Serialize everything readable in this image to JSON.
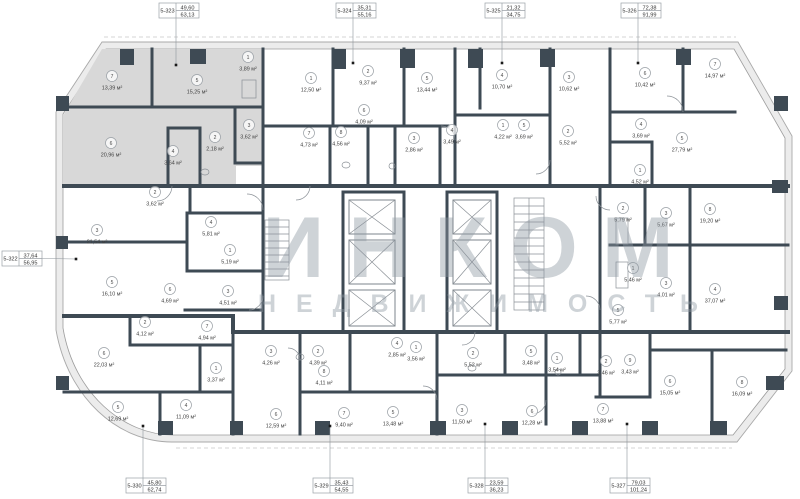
{
  "watermark": {
    "line1": "ИНКОМ",
    "line2": "НЕДВИЖИМОСТЬ"
  },
  "area_unit": "м²",
  "colors": {
    "wall": "#3e4a54",
    "highlighted_unit": "#d8d8d8",
    "outer_band": "#ececec",
    "watermark": "#8d97a1",
    "label_border": "#9aa0a6"
  },
  "callouts": [
    {
      "unit": "5-323",
      "value_top": "49,60",
      "value_bottom": "63,13",
      "side": "top",
      "box_x": 159,
      "box_y": 3,
      "dot_x": 176,
      "dot_y": 65
    },
    {
      "unit": "5-324",
      "value_top": "35,31",
      "value_bottom": "55,16",
      "side": "top",
      "box_x": 336,
      "box_y": 3,
      "dot_x": 353,
      "dot_y": 63
    },
    {
      "unit": "5-325",
      "value_top": "21,32",
      "value_bottom": "34,75",
      "side": "top",
      "box_x": 485,
      "box_y": 3,
      "dot_x": 502,
      "dot_y": 63
    },
    {
      "unit": "5-326",
      "value_top": "72,38",
      "value_bottom": "91,99",
      "side": "top",
      "box_x": 621,
      "box_y": 3,
      "dot_x": 638,
      "dot_y": 63
    },
    {
      "unit": "5-322",
      "value_top": "37,64",
      "value_bottom": "56,95",
      "side": "left",
      "box_x": 2,
      "box_y": 251,
      "dot_x": 76,
      "dot_y": 259
    },
    {
      "unit": "5-330",
      "value_top": "45,80",
      "value_bottom": "62,74",
      "side": "bottom",
      "box_x": 126,
      "box_y": 478,
      "dot_x": 143,
      "dot_y": 426
    },
    {
      "unit": "5-329",
      "value_top": "35,43",
      "value_bottom": "54,55",
      "side": "bottom",
      "box_x": 313,
      "box_y": 478,
      "dot_x": 330,
      "dot_y": 426
    },
    {
      "unit": "5-328",
      "value_top": "23,59",
      "value_bottom": "36,23",
      "side": "bottom",
      "box_x": 468,
      "box_y": 478,
      "dot_x": 485,
      "dot_y": 424
    },
    {
      "unit": "5-327",
      "value_top": "79,03",
      "value_bottom": "101,24",
      "side": "bottom",
      "box_x": 610,
      "box_y": 478,
      "dot_x": 627,
      "dot_y": 424
    }
  ],
  "rooms": [
    {
      "n": "7",
      "area": "13,39 м²",
      "x": 112,
      "y": 76
    },
    {
      "n": "5",
      "area": "15,25 м²",
      "x": 197,
      "y": 80
    },
    {
      "n": "1",
      "area": "3,89 м²",
      "x": 248,
      "y": 57
    },
    {
      "n": "6",
      "area": "20,96 м²",
      "x": 111,
      "y": 143
    },
    {
      "n": "4",
      "area": "3,64 м²",
      "x": 173,
      "y": 151
    },
    {
      "n": "2",
      "area": "2,18 м²",
      "x": 215,
      "y": 137
    },
    {
      "n": "3",
      "area": "3,62 м²",
      "x": 249,
      "y": 125
    },
    {
      "n": "1",
      "area": "12,50 м²",
      "x": 311,
      "y": 78
    },
    {
      "n": "2",
      "area": "9,37 м²",
      "x": 368,
      "y": 71
    },
    {
      "n": "5",
      "area": "13,44 м²",
      "x": 427,
      "y": 78
    },
    {
      "n": "6",
      "area": "4,09 м²",
      "x": 364,
      "y": 110
    },
    {
      "n": "7",
      "area": "4,73 м²",
      "x": 309,
      "y": 133
    },
    {
      "n": "8",
      "area": "4,56 м²",
      "x": 341,
      "y": 132
    },
    {
      "n": "3",
      "area": "2,86 м²",
      "x": 414,
      "y": 138
    },
    {
      "n": "4",
      "area": "3,49 м²",
      "x": 452,
      "y": 130
    },
    {
      "n": "4",
      "area": "10,70 м²",
      "x": 502,
      "y": 75
    },
    {
      "n": "3",
      "area": "10,62 м²",
      "x": 569,
      "y": 77
    },
    {
      "n": "1",
      "area": "4,22 м²",
      "x": 503,
      "y": 125
    },
    {
      "n": "5",
      "area": "3,69 м²",
      "x": 524,
      "y": 125
    },
    {
      "n": "2",
      "area": "5,52 м²",
      "x": 568,
      "y": 131
    },
    {
      "n": "6",
      "area": "10,42 м²",
      "x": 645,
      "y": 73
    },
    {
      "n": "7",
      "area": "14,97 м²",
      "x": 715,
      "y": 64
    },
    {
      "n": "4",
      "area": "3,69 м²",
      "x": 641,
      "y": 124
    },
    {
      "n": "5",
      "area": "27,79 м²",
      "x": 682,
      "y": 138
    },
    {
      "n": "1",
      "area": "4,52 м²",
      "x": 640,
      "y": 170
    },
    {
      "n": "2",
      "area": "5,79 м²",
      "x": 623,
      "y": 208
    },
    {
      "n": "3",
      "area": "5,67 м²",
      "x": 666,
      "y": 213
    },
    {
      "n": "8",
      "area": "19,20 м²",
      "x": 710,
      "y": 209
    },
    {
      "n": "1",
      "area": "5,46 м²",
      "x": 633,
      "y": 268
    },
    {
      "n": "3",
      "area": "4,01 м²",
      "x": 666,
      "y": 283
    },
    {
      "n": "4",
      "area": "37,07 м²",
      "x": 715,
      "y": 289
    },
    {
      "n": "5",
      "area": "5,77 м²",
      "x": 618,
      "y": 310
    },
    {
      "n": "2",
      "area": "3,46 м²",
      "x": 606,
      "y": 361
    },
    {
      "n": "9",
      "area": "3,43 м²",
      "x": 630,
      "y": 360
    },
    {
      "n": "6",
      "area": "15,05 м²",
      "x": 670,
      "y": 381
    },
    {
      "n": "8",
      "area": "16,09 м²",
      "x": 742,
      "y": 382
    },
    {
      "n": "7",
      "area": "13,88 м²",
      "x": 603,
      "y": 409
    },
    {
      "n": "1",
      "area": "3,56 м²",
      "x": 416,
      "y": 347
    },
    {
      "n": "2",
      "area": "5,52 м²",
      "x": 473,
      "y": 353
    },
    {
      "n": "5",
      "area": "3,48 м²",
      "x": 531,
      "y": 351
    },
    {
      "n": "1",
      "area": "3,54 м²",
      "x": 557,
      "y": 358
    },
    {
      "n": "3",
      "area": "11,50 м²",
      "x": 462,
      "y": 410
    },
    {
      "n": "6",
      "area": "12,28 м²",
      "x": 532,
      "y": 411
    },
    {
      "n": "3",
      "area": "4,26 м²",
      "x": 271,
      "y": 351
    },
    {
      "n": "2",
      "area": "4,39 м²",
      "x": 318,
      "y": 351
    },
    {
      "n": "8",
      "area": "4,11 м²",
      "x": 324,
      "y": 371
    },
    {
      "n": "4",
      "area": "2,85 м²",
      "x": 397,
      "y": 343
    },
    {
      "n": "6",
      "area": "12,59 м²",
      "x": 276,
      "y": 414
    },
    {
      "n": "7",
      "area": "9,40 м²",
      "x": 344,
      "y": 413
    },
    {
      "n": "5",
      "area": "13,48 м²",
      "x": 393,
      "y": 412
    },
    {
      "n": "2",
      "area": "4,12 м²",
      "x": 145,
      "y": 322
    },
    {
      "n": "7",
      "area": "4,94 м²",
      "x": 207,
      "y": 326
    },
    {
      "n": "6",
      "area": "22,03 м²",
      "x": 104,
      "y": 353
    },
    {
      "n": "1",
      "area": "3,37 м²",
      "x": 216,
      "y": 368
    },
    {
      "n": "5",
      "area": "12,69 м²",
      "x": 118,
      "y": 407
    },
    {
      "n": "4",
      "area": "11,09 м²",
      "x": 186,
      "y": 405
    },
    {
      "n": "2",
      "area": "3,62 м²",
      "x": 155,
      "y": 192
    },
    {
      "n": "3",
      "area": "21,54 м²",
      "x": 97,
      "y": 230
    },
    {
      "n": "4",
      "area": "5,81 м²",
      "x": 211,
      "y": 222
    },
    {
      "n": "1",
      "area": "5,19 м²",
      "x": 230,
      "y": 250
    },
    {
      "n": "5",
      "area": "16,10 м²",
      "x": 112,
      "y": 282
    },
    {
      "n": "6",
      "area": "4,69 м²",
      "x": 170,
      "y": 289
    },
    {
      "n": "3",
      "area": "4,51 м²",
      "x": 228,
      "y": 291
    }
  ]
}
